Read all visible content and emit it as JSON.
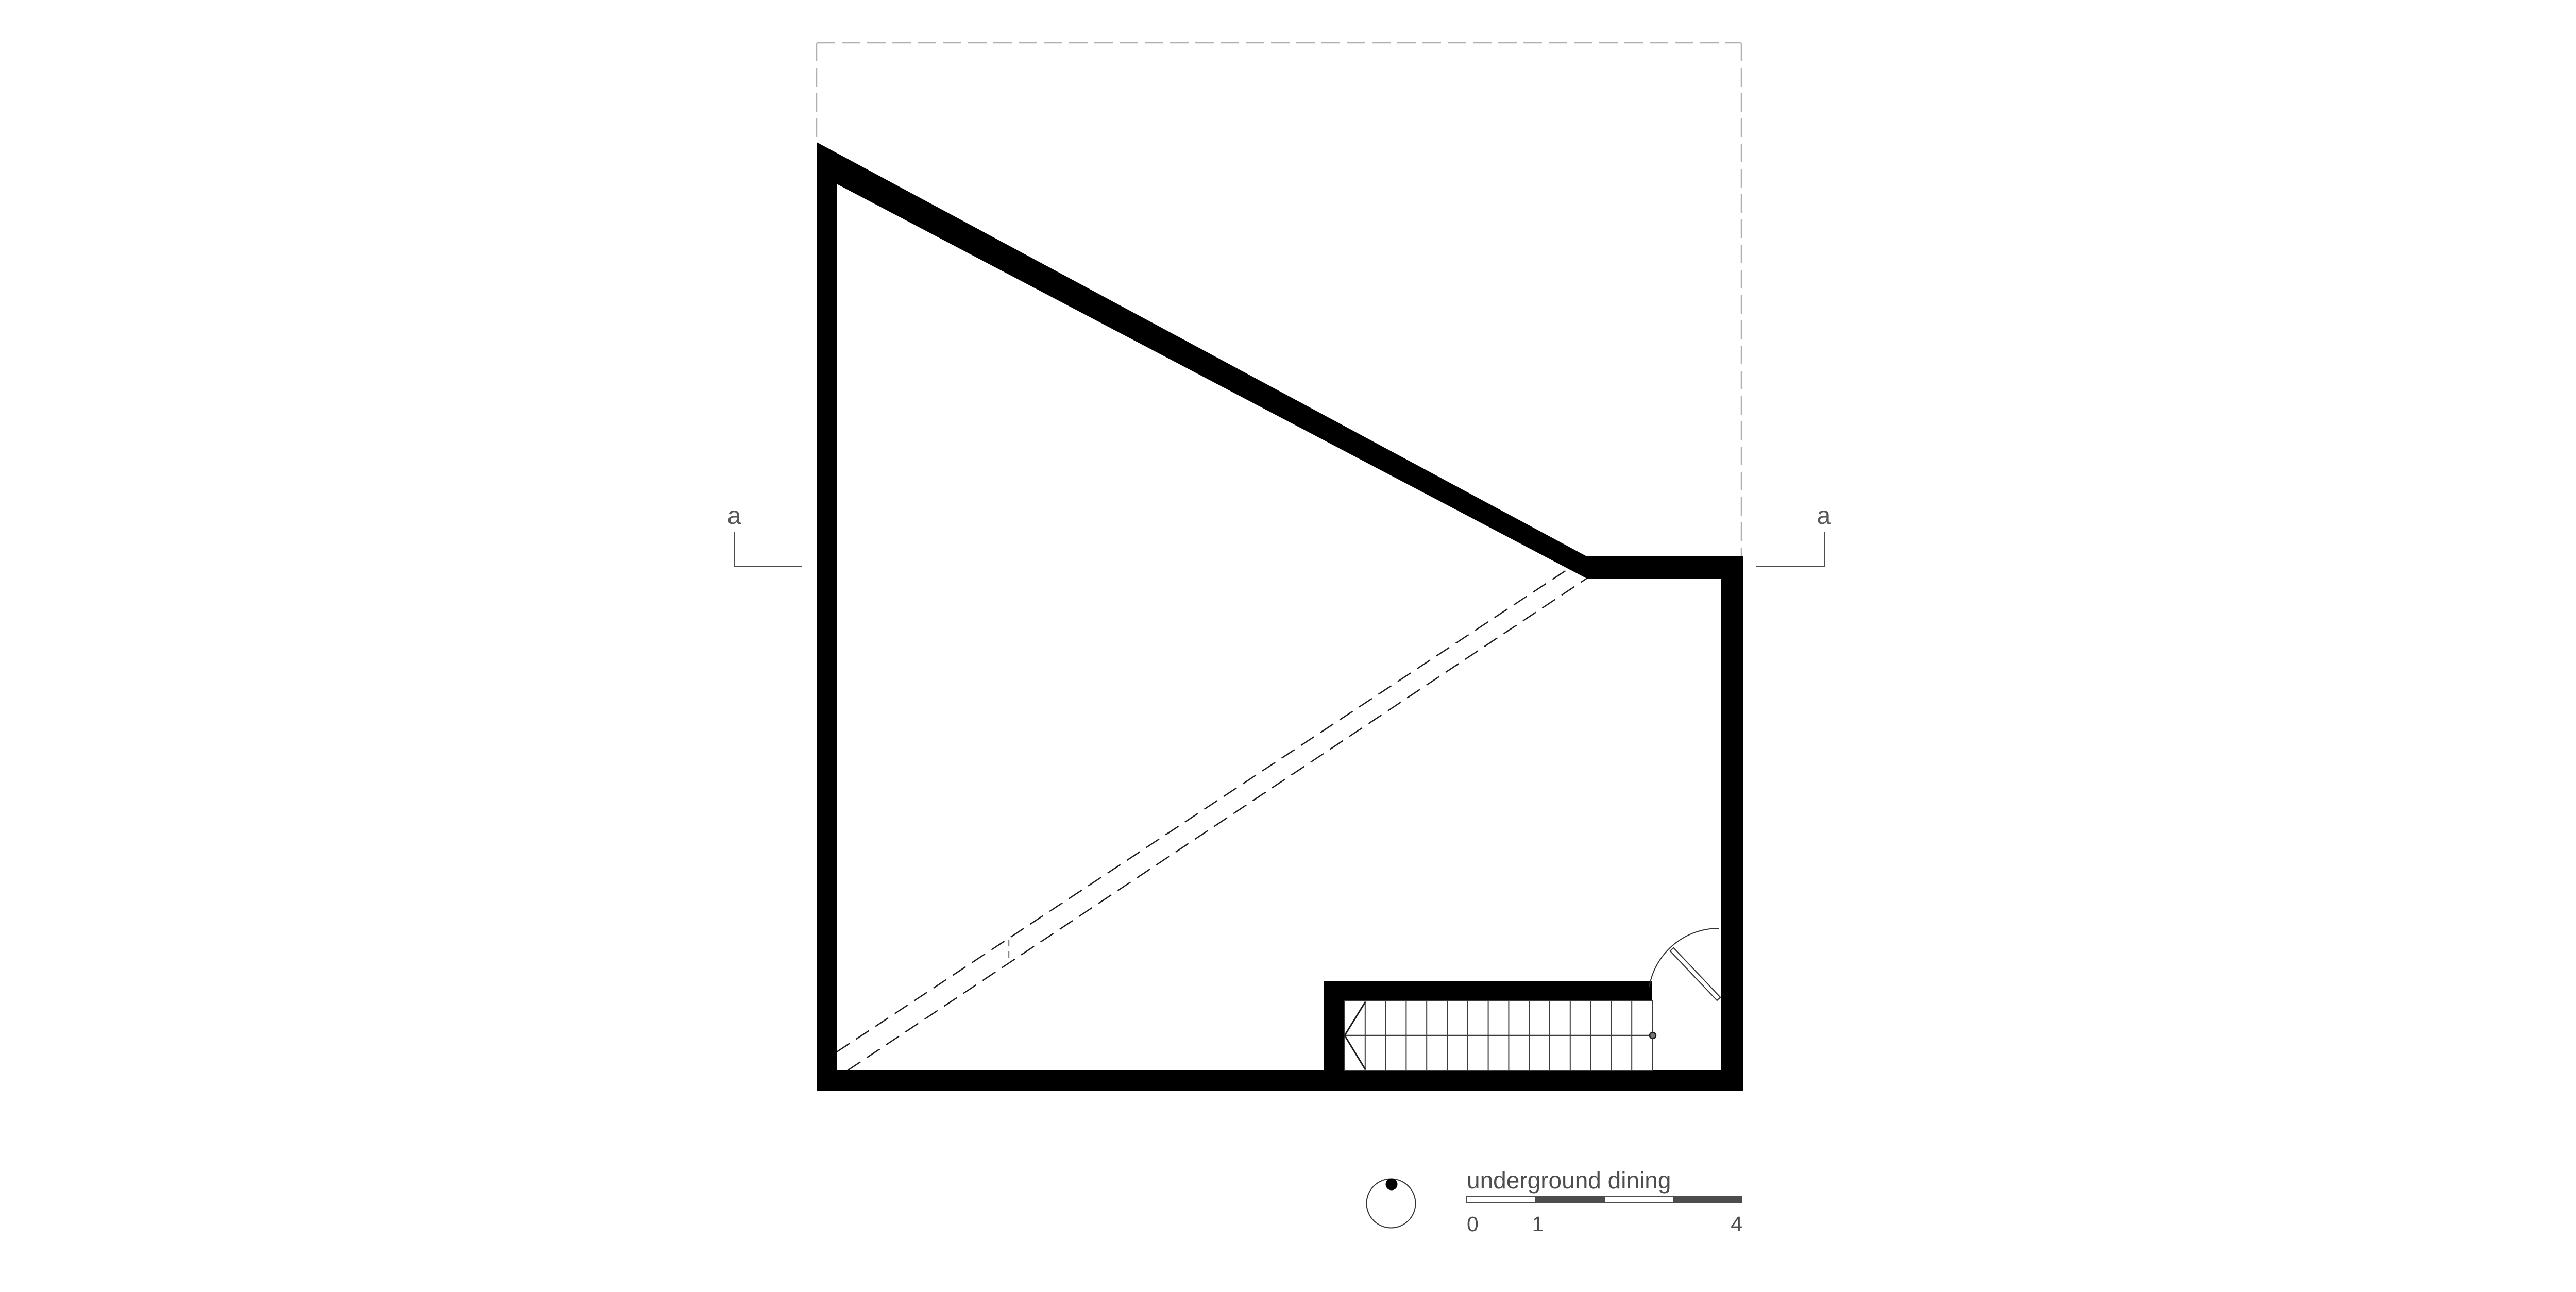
{
  "drawing": {
    "title_block": {
      "title": "underground dining",
      "scale_start_label": "0",
      "scale_mid_label": "1",
      "scale_end_label": "4"
    },
    "annotations": {
      "section_marker_left": "a",
      "section_marker_right": "a"
    },
    "legend": {
      "north_indicator": "north-circle-with-dot",
      "stair_direction": "arrow-pointing-left-with-start-circle"
    },
    "colors": {
      "background": "#ffffff",
      "wall": "#000000",
      "annotation_line": "#4d4d4d",
      "label_text": "#575757",
      "boundary_dashed": "#b0b0b0",
      "scale_bar_dark": "#4d4d4d",
      "thin_plan_line": "#3c3c3c"
    }
  }
}
